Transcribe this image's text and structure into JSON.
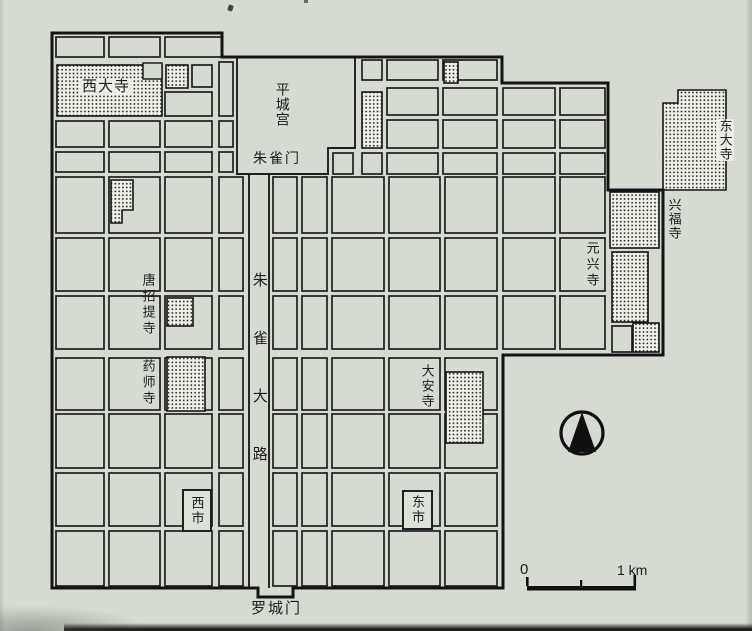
{
  "map": {
    "description": "Plan of the ancient capital Heijo-kyo with temples, markets, palace, Suzaku avenue, north arrow and scale bar",
    "labels": {
      "saidaiji": "西大寺",
      "heijo_palace": "平城宫",
      "suzaku_gate": "朱雀门",
      "todaiji": "东大寺",
      "kofukuji": "兴福寺",
      "gangoji": "元兴寺",
      "toshodaiji": "唐招提寺",
      "yakushiji": "药师寺",
      "suzaku_avenue": "朱雀大路",
      "daianji": "大安寺",
      "west_market": "西市",
      "east_market": "东市",
      "rajomon_gate": "罗城门"
    },
    "scale_bar": {
      "start": "0",
      "end": "1 km"
    },
    "compass": {
      "type": "north-arrow"
    },
    "colors": {
      "paper": "#d6dbd2",
      "ink": "#1e1e1e",
      "hatch_bg": "#eff0e8"
    }
  }
}
